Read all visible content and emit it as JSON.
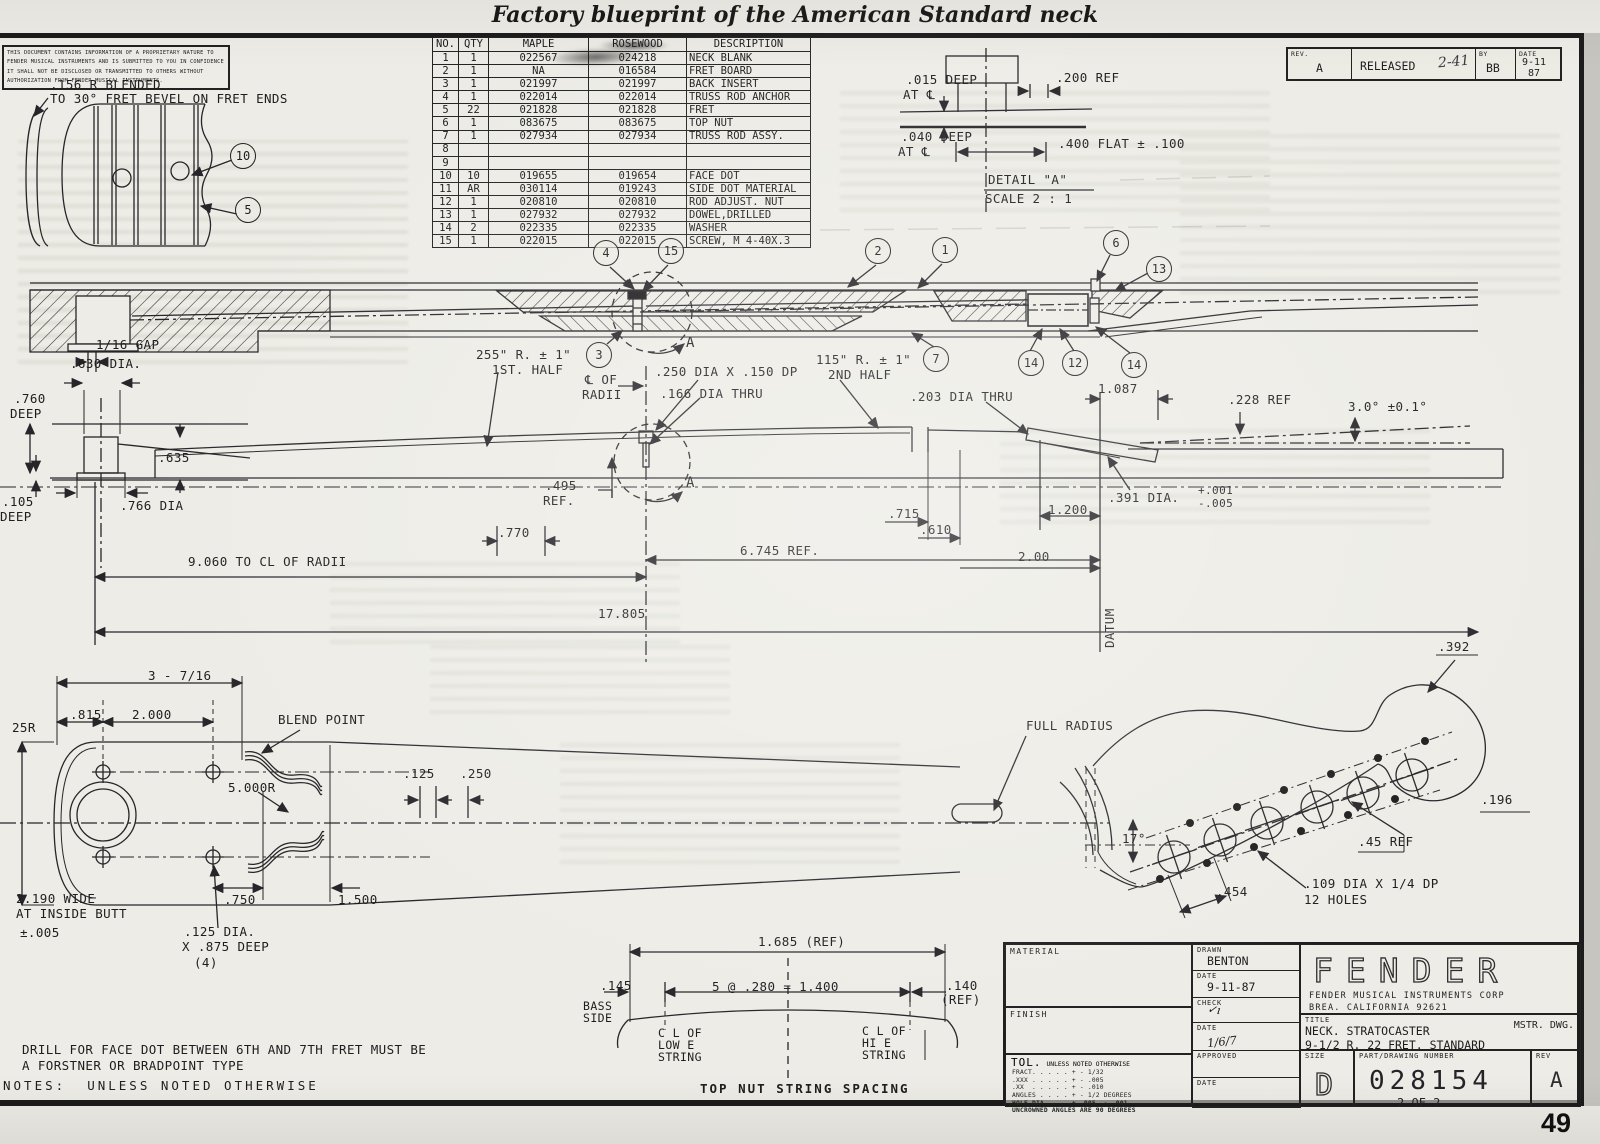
{
  "page": {
    "caption": "Factory blueprint of the American Standard neck",
    "page_number": "49"
  },
  "colors": {
    "ink": "#26262a",
    "paper": "#edece6",
    "accent": "#1e1e20"
  },
  "notice": {
    "lines": [
      "THIS DOCUMENT CONTAINS INFORMATION OF A PROPRIETARY NATURE TO",
      "FENDER MUSICAL INSTRUMENTS AND IS SUBMITTED TO YOU IN CONFIDENCE",
      "IT SHALL NOT BE DISCLOSED OR TRANSMITTED TO OTHERS WITHOUT",
      "AUTHORIZATION FROM FENDER MUSICAL INSTRUMENTS."
    ]
  },
  "parts_table": {
    "headers": [
      "NO.",
      "QTY",
      "MAPLE",
      "ROSEWOOD",
      "DESCRIPTION"
    ],
    "rows": [
      [
        "1",
        "1",
        "022567",
        "024218",
        "NECK BLANK"
      ],
      [
        "2",
        "1",
        "NA",
        "016584",
        "FRET BOARD"
      ],
      [
        "3",
        "1",
        "021997",
        "021997",
        "BACK INSERT"
      ],
      [
        "4",
        "1",
        "022014",
        "022014",
        "TRUSS ROD ANCHOR"
      ],
      [
        "5",
        "22",
        "021828",
        "021828",
        "FRET"
      ],
      [
        "6",
        "1",
        "083675",
        "083675",
        "TOP NUT"
      ],
      [
        "7",
        "1",
        "027934",
        "027934",
        "TRUSS ROD ASSY."
      ],
      [
        "8",
        "",
        "",
        "",
        ""
      ],
      [
        "9",
        "",
        "",
        "",
        ""
      ],
      [
        "10",
        "10",
        "019655",
        "019654",
        "FACE DOT"
      ],
      [
        "11",
        "AR",
        "030114",
        "019243",
        "SIDE DOT MATERIAL"
      ],
      [
        "12",
        "1",
        "020810",
        "020810",
        "ROD ADJUST. NUT"
      ],
      [
        "13",
        "1",
        "027932",
        "027932",
        "DOWEL,DRILLED"
      ],
      [
        "14",
        "2",
        "022335",
        "022335",
        "WASHER"
      ],
      [
        "15",
        "1",
        "022015",
        "022015",
        "SCREW, M 4-40X.3"
      ]
    ]
  },
  "revision_strip": {
    "rev_label": "REV.",
    "rev_value": "A",
    "released_label": "RELEASED",
    "released_hand": "2-41",
    "by_label": "BY",
    "by_value": "BB",
    "date_label": "DATE",
    "date_value": "9-11",
    "date_year": "87"
  },
  "title_block": {
    "material_label": "MATERIAL",
    "finish_label": "FINISH",
    "tol_label": "TOL.",
    "tol_note": "UNLESS NOTED OTHERWISE",
    "tol_lines": [
      "FRACT. . . . . + - 1/32",
      ".XXX . . . . . + - .005",
      ".XX  . . . . . + - .010",
      "ANGLES . . . . + - 1/2 DEGREES",
      "HOLE DIA. . .  + .005. - .001",
      "UNCROWNED ANGLES ARE 90 DEGREES"
    ],
    "drawn_label": "DRAWN",
    "drawn_value": "BENTON",
    "date1_label": "DATE",
    "date1_value": "9-11-87",
    "check_label": "CHECK",
    "check_hand": "✓ı",
    "date2_label": "DATE",
    "date2_hand": "1/6/7",
    "approved_label": "APPROVED",
    "date3_label": "DATE",
    "logo": "FENDER",
    "corp_line1": "FENDER MUSICAL INSTRUMENTS CORP",
    "corp_line2": "BREA. CALIFORNIA 92621",
    "title_label": "TITLE",
    "title_line1": "NECK. STRATOCASTER",
    "title_line2": "9-1/2 R. 22 FRET. STANDARD",
    "mstr": "MSTR. DWG.",
    "size_label": "SIZE",
    "size_value": "D",
    "part_label": "PART/DRAWING NUMBER",
    "part_value": "028154",
    "sheet": "2 OF 2",
    "rev_label": "REV",
    "rev_value": "A"
  },
  "balloons": [
    {
      "x": 244,
      "y": 157,
      "n": "10"
    },
    {
      "x": 249,
      "y": 211,
      "n": "5"
    },
    {
      "x": 607,
      "y": 254,
      "n": "4"
    },
    {
      "x": 672,
      "y": 252,
      "n": "15"
    },
    {
      "x": 600,
      "y": 356,
      "n": "3"
    },
    {
      "x": 879,
      "y": 252,
      "n": "2"
    },
    {
      "x": 946,
      "y": 251,
      "n": "1"
    },
    {
      "x": 1117,
      "y": 244,
      "n": "6"
    },
    {
      "x": 1160,
      "y": 270,
      "n": "13"
    },
    {
      "x": 937,
      "y": 360,
      "n": "7"
    },
    {
      "x": 1032,
      "y": 364,
      "n": "14"
    },
    {
      "x": 1076,
      "y": 364,
      "n": "12"
    },
    {
      "x": 1135,
      "y": 366,
      "n": "14"
    }
  ],
  "annotations": [
    {
      "x": 50,
      "y": 79,
      "t": ".156 R BLENDED"
    },
    {
      "x": 50,
      "y": 93,
      "t": "TO 30° FRET BEVEL ON FRET ENDS"
    },
    {
      "x": 906,
      "y": 74,
      "t": ".015 DEEP"
    },
    {
      "x": 903,
      "y": 89,
      "t": "AT ℄"
    },
    {
      "x": 1056,
      "y": 72,
      "t": ".200 REF"
    },
    {
      "x": 901,
      "y": 131,
      "t": ".040 DEEP"
    },
    {
      "x": 898,
      "y": 146,
      "t": "AT ℄"
    },
    {
      "x": 1058,
      "y": 138,
      "t": ".400 FLAT ± .100"
    },
    {
      "x": 988,
      "y": 174,
      "t": "DETAIL \"A\""
    },
    {
      "x": 985,
      "y": 193,
      "t": "SCALE 2 : 1"
    },
    {
      "x": 476,
      "y": 349,
      "t": "255\" R. ± 1\""
    },
    {
      "x": 492,
      "y": 364,
      "t": "1ST. HALF"
    },
    {
      "x": 585,
      "y": 374,
      "t": "℄ OF"
    },
    {
      "x": 582,
      "y": 389,
      "t": "RADII"
    },
    {
      "x": 655,
      "y": 366,
      "t": ".250 DIA X .150 DP"
    },
    {
      "x": 660,
      "y": 388,
      "t": ".166 DIA THRU"
    },
    {
      "x": 816,
      "y": 354,
      "t": "115\" R. ± 1\""
    },
    {
      "x": 828,
      "y": 369,
      "t": "2ND HALF"
    },
    {
      "x": 910,
      "y": 391,
      "t": ".203 DIA THRU"
    },
    {
      "x": 1098,
      "y": 383,
      "t": "1.087"
    },
    {
      "x": 1228,
      "y": 394,
      "t": ".228 REF"
    },
    {
      "x": 1348,
      "y": 401,
      "t": "3.0° ±0.1°"
    },
    {
      "x": 1108,
      "y": 492,
      "t": ".391 DIA."
    },
    {
      "x": 1198,
      "y": 485,
      "t": "+.001",
      "fs": 11
    },
    {
      "x": 1198,
      "y": 498,
      "t": "-.005",
      "fs": 11
    },
    {
      "x": 888,
      "y": 508,
      "t": ".715"
    },
    {
      "x": 920,
      "y": 524,
      "t": ".610"
    },
    {
      "x": 1048,
      "y": 504,
      "t": "1.200"
    },
    {
      "x": 1018,
      "y": 551,
      "t": "2.00"
    },
    {
      "x": 545,
      "y": 480,
      "t": ".495"
    },
    {
      "x": 543,
      "y": 495,
      "t": "REF."
    },
    {
      "x": 498,
      "y": 527,
      "t": ".770"
    },
    {
      "x": 188,
      "y": 556,
      "t": "9.060 TO CL OF RADII"
    },
    {
      "x": 740,
      "y": 545,
      "t": "6.745 REF."
    },
    {
      "x": 598,
      "y": 608,
      "t": "17.805"
    },
    {
      "x": 96,
      "y": 339,
      "t": "1/16 GAP"
    },
    {
      "x": 70,
      "y": 358,
      "t": ".630 DIA."
    },
    {
      "x": 14,
      "y": 393,
      "t": ".760"
    },
    {
      "x": 10,
      "y": 408,
      "t": "DEEP"
    },
    {
      "x": 158,
      "y": 452,
      "t": ".635"
    },
    {
      "x": 2,
      "y": 496,
      "t": ".105"
    },
    {
      "x": 0,
      "y": 511,
      "t": "DEEP"
    },
    {
      "x": 120,
      "y": 500,
      "t": ".766 DIA"
    },
    {
      "x": 686,
      "y": 336,
      "t": "A",
      "fs": 14
    },
    {
      "x": 686,
      "y": 476,
      "t": "A",
      "fs": 14
    },
    {
      "x": 1104,
      "y": 648,
      "t": "DATUM",
      "rot": -90,
      "n": "datum-label"
    },
    {
      "x": 148,
      "y": 670,
      "t": "3 - 7/16"
    },
    {
      "x": 70,
      "y": 709,
      "t": ".815"
    },
    {
      "x": 132,
      "y": 709,
      "t": "2.000"
    },
    {
      "x": 278,
      "y": 714,
      "t": "BLEND POINT"
    },
    {
      "x": 12,
      "y": 722,
      "t": "25R"
    },
    {
      "x": 228,
      "y": 782,
      "t": "5.000R"
    },
    {
      "x": 403,
      "y": 768,
      "t": ".125"
    },
    {
      "x": 460,
      "y": 768,
      "t": ".250"
    },
    {
      "x": 16,
      "y": 893,
      "t": "2.190 WIDE"
    },
    {
      "x": 16,
      "y": 908,
      "t": "AT INSIDE BUTT"
    },
    {
      "x": 20,
      "y": 927,
      "t": "±.005"
    },
    {
      "x": 224,
      "y": 894,
      "t": ".750"
    },
    {
      "x": 338,
      "y": 894,
      "t": "1.500"
    },
    {
      "x": 184,
      "y": 926,
      "t": ".125 DIA."
    },
    {
      "x": 182,
      "y": 941,
      "t": "X .875 DEEP"
    },
    {
      "x": 194,
      "y": 957,
      "t": "(4)"
    },
    {
      "x": 1026,
      "y": 720,
      "t": "FULL RADIUS"
    },
    {
      "x": 1122,
      "y": 833,
      "t": "17°"
    },
    {
      "x": 1216,
      "y": 886,
      "t": ".454"
    },
    {
      "x": 1358,
      "y": 836,
      "t": ".45 REF"
    },
    {
      "x": 1304,
      "y": 878,
      "t": ".109 DIA X 1/4 DP"
    },
    {
      "x": 1304,
      "y": 894,
      "t": "12 HOLES"
    },
    {
      "x": 1438,
      "y": 641,
      "t": ".392"
    },
    {
      "x": 1481,
      "y": 794,
      "t": ".196"
    },
    {
      "x": 758,
      "y": 936,
      "t": "1.685 (REF)"
    },
    {
      "x": 600,
      "y": 980,
      "t": ".145"
    },
    {
      "x": 712,
      "y": 981,
      "t": "5 @ .280 = 1.400"
    },
    {
      "x": 946,
      "y": 980,
      "t": ".140"
    },
    {
      "x": 941,
      "y": 994,
      "t": "(REF)"
    },
    {
      "x": 583,
      "y": 1001,
      "t": "BASS",
      "fs": 11.5
    },
    {
      "x": 583,
      "y": 1013,
      "t": "SIDE",
      "fs": 11.5
    },
    {
      "x": 658,
      "y": 1028,
      "t": "C L OF",
      "fs": 11.5
    },
    {
      "x": 658,
      "y": 1040,
      "t": "LOW E",
      "fs": 11.5
    },
    {
      "x": 658,
      "y": 1052,
      "t": "STRING",
      "fs": 11.5
    },
    {
      "x": 862,
      "y": 1026,
      "t": "C L OF",
      "fs": 11.5
    },
    {
      "x": 862,
      "y": 1038,
      "t": "HI E",
      "fs": 11.5
    },
    {
      "x": 862,
      "y": 1050,
      "t": "STRING",
      "fs": 11.5
    },
    {
      "x": 700,
      "y": 1083,
      "t": "TOP NUT STRING SPACING",
      "b": 1,
      "ls": 2,
      "n": "view-title-top-nut"
    },
    {
      "x": 22,
      "y": 1044,
      "t": "DRILL FOR FACE DOT BETWEEN 6TH AND 7TH FRET MUST BE",
      "n": "note-line"
    },
    {
      "x": 22,
      "y": 1060,
      "t": "A FORSTNER OR BRADPOINT TYPE",
      "n": "note-line"
    },
    {
      "x": 3,
      "y": 1080,
      "t": "NOTES:  UNLESS NOTED OTHERWISE",
      "ls": 3,
      "n": "notes-header"
    }
  ]
}
